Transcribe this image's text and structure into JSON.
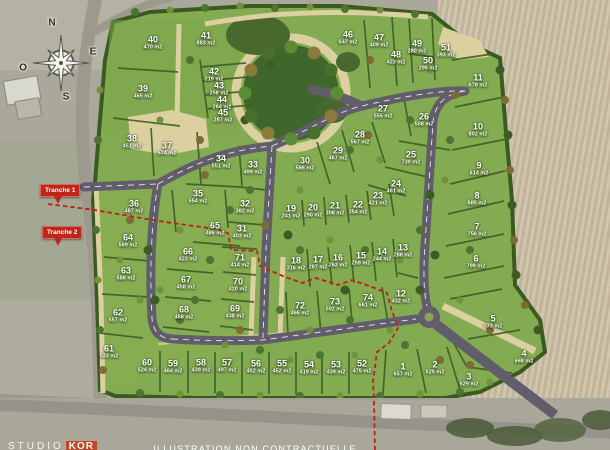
{
  "map": {
    "compass": {
      "north": "N",
      "east": "E",
      "south": "S",
      "west": "O"
    },
    "tranches": [
      {
        "label": "Tranche 1"
      },
      {
        "label": "Tranche 2"
      }
    ],
    "footer": {
      "studio_prefix": "STUDIO",
      "studio_suffix": "KOR",
      "disclaimer": "ILLUSTRATION NON CONTRACTUELLE"
    },
    "colors": {
      "lot_green": "#83ab51",
      "hedge_green": "#3e5c25",
      "road": "#615d6b",
      "path_beige": "#dccfa0",
      "tranche_red": "#c0251a",
      "field_beige": "#cbbfa5"
    },
    "lots": [
      {
        "n": "1",
        "a": "657 m2",
        "x": 403,
        "y": 370
      },
      {
        "n": "2",
        "a": "525 m2",
        "x": 435,
        "y": 368
      },
      {
        "n": "3",
        "a": "529 m2",
        "x": 469,
        "y": 380
      },
      {
        "n": "4",
        "a": "668 m2",
        "x": 524,
        "y": 357
      },
      {
        "n": "5",
        "a": "773 m2",
        "x": 493,
        "y": 322
      },
      {
        "n": "6",
        "a": "799 m2",
        "x": 476,
        "y": 262
      },
      {
        "n": "7",
        "a": "756 m2",
        "x": 477,
        "y": 230
      },
      {
        "n": "8",
        "a": "685 m2",
        "x": 477,
        "y": 199
      },
      {
        "n": "9",
        "a": "614 m2",
        "x": 479,
        "y": 169
      },
      {
        "n": "10",
        "a": "802 m2",
        "x": 478,
        "y": 130
      },
      {
        "n": "11",
        "a": "678 m2",
        "x": 478,
        "y": 81
      },
      {
        "n": "12",
        "a": "432 m2",
        "x": 401,
        "y": 297
      },
      {
        "n": "13",
        "a": "288 m2",
        "x": 403,
        "y": 251
      },
      {
        "n": "14",
        "a": "244 m2",
        "x": 382,
        "y": 255
      },
      {
        "n": "15",
        "a": "259 m2",
        "x": 361,
        "y": 259
      },
      {
        "n": "16",
        "a": "263 m2",
        "x": 338,
        "y": 261
      },
      {
        "n": "17",
        "a": "287 m2",
        "x": 318,
        "y": 263
      },
      {
        "n": "18",
        "a": "316 m2",
        "x": 296,
        "y": 264
      },
      {
        "n": "19",
        "a": "241 m2",
        "x": 291,
        "y": 212
      },
      {
        "n": "20",
        "a": "290 m2",
        "x": 313,
        "y": 211
      },
      {
        "n": "21",
        "a": "308 m2",
        "x": 335,
        "y": 209
      },
      {
        "n": "22",
        "a": "354 m2",
        "x": 358,
        "y": 208
      },
      {
        "n": "23",
        "a": "421 m2",
        "x": 378,
        "y": 199
      },
      {
        "n": "24",
        "a": "461 m2",
        "x": 396,
        "y": 187
      },
      {
        "n": "25",
        "a": "730 m2",
        "x": 411,
        "y": 158
      },
      {
        "n": "26",
        "a": "508 m2",
        "x": 424,
        "y": 120
      },
      {
        "n": "27",
        "a": "555 m2",
        "x": 383,
        "y": 112
      },
      {
        "n": "28",
        "a": "567 m2",
        "x": 360,
        "y": 138
      },
      {
        "n": "29",
        "a": "467 m2",
        "x": 338,
        "y": 154
      },
      {
        "n": "30",
        "a": "586 m2",
        "x": 305,
        "y": 164
      },
      {
        "n": "31",
        "a": "403 m2",
        "x": 242,
        "y": 232
      },
      {
        "n": "32",
        "a": "382 m2",
        "x": 245,
        "y": 207
      },
      {
        "n": "33",
        "a": "499 m2",
        "x": 253,
        "y": 168
      },
      {
        "n": "34",
        "a": "551 m2",
        "x": 221,
        "y": 162
      },
      {
        "n": "35",
        "a": "554 m2",
        "x": 198,
        "y": 197
      },
      {
        "n": "36",
        "a": "487 m2",
        "x": 134,
        "y": 207
      },
      {
        "n": "37",
        "a": "574 m2",
        "x": 167,
        "y": 149
      },
      {
        "n": "38",
        "a": "451 m2",
        "x": 132,
        "y": 142
      },
      {
        "n": "39",
        "a": "465 m2",
        "x": 143,
        "y": 92
      },
      {
        "n": "40",
        "a": "470 m2",
        "x": 153,
        "y": 43
      },
      {
        "n": "41",
        "a": "883 m2",
        "x": 206,
        "y": 39
      },
      {
        "n": "42",
        "a": "219 m2",
        "x": 214,
        "y": 75
      },
      {
        "n": "43",
        "a": "258 m2",
        "x": 219,
        "y": 89
      },
      {
        "n": "44",
        "a": "264 m2",
        "x": 222,
        "y": 103
      },
      {
        "n": "45",
        "a": "287 m2",
        "x": 223,
        "y": 116
      },
      {
        "n": "46",
        "a": "647 m2",
        "x": 348,
        "y": 38
      },
      {
        "n": "47",
        "a": "409 m2",
        "x": 379,
        "y": 41
      },
      {
        "n": "48",
        "a": "423 m2",
        "x": 396,
        "y": 58
      },
      {
        "n": "49",
        "a": "280 m2",
        "x": 417,
        "y": 47
      },
      {
        "n": "50",
        "a": "295 m2",
        "x": 428,
        "y": 64
      },
      {
        "n": "51",
        "a": "393 m2",
        "x": 446,
        "y": 51
      },
      {
        "n": "52",
        "a": "475 m2",
        "x": 362,
        "y": 367
      },
      {
        "n": "53",
        "a": "439 m2",
        "x": 336,
        "y": 368
      },
      {
        "n": "54",
        "a": "419 m2",
        "x": 309,
        "y": 368
      },
      {
        "n": "55",
        "a": "452 m2",
        "x": 282,
        "y": 367
      },
      {
        "n": "56",
        "a": "452 m2",
        "x": 256,
        "y": 367
      },
      {
        "n": "57",
        "a": "497 m2",
        "x": 227,
        "y": 366
      },
      {
        "n": "58",
        "a": "439 m2",
        "x": 201,
        "y": 366
      },
      {
        "n": "59",
        "a": "464 m2",
        "x": 173,
        "y": 367
      },
      {
        "n": "60",
        "a": "524 m2",
        "x": 147,
        "y": 366
      },
      {
        "n": "61",
        "a": "533 m2",
        "x": 109,
        "y": 352
      },
      {
        "n": "62",
        "a": "557 m2",
        "x": 118,
        "y": 316
      },
      {
        "n": "63",
        "a": "588 m2",
        "x": 126,
        "y": 274
      },
      {
        "n": "64",
        "a": "569 m2",
        "x": 128,
        "y": 241
      },
      {
        "n": "65",
        "a": "486 m2",
        "x": 215,
        "y": 229
      },
      {
        "n": "66",
        "a": "423 m2",
        "x": 188,
        "y": 255
      },
      {
        "n": "67",
        "a": "458 m2",
        "x": 186,
        "y": 283
      },
      {
        "n": "68",
        "a": "468 m2",
        "x": 184,
        "y": 313
      },
      {
        "n": "69",
        "a": "438 m2",
        "x": 235,
        "y": 312
      },
      {
        "n": "70",
        "a": "420 m2",
        "x": 238,
        "y": 285
      },
      {
        "n": "71",
        "a": "414 m2",
        "x": 240,
        "y": 261
      },
      {
        "n": "72",
        "a": "466 m2",
        "x": 300,
        "y": 309
      },
      {
        "n": "73",
        "a": "502 m2",
        "x": 335,
        "y": 305
      },
      {
        "n": "74",
        "a": "661 m2",
        "x": 368,
        "y": 301
      }
    ]
  }
}
